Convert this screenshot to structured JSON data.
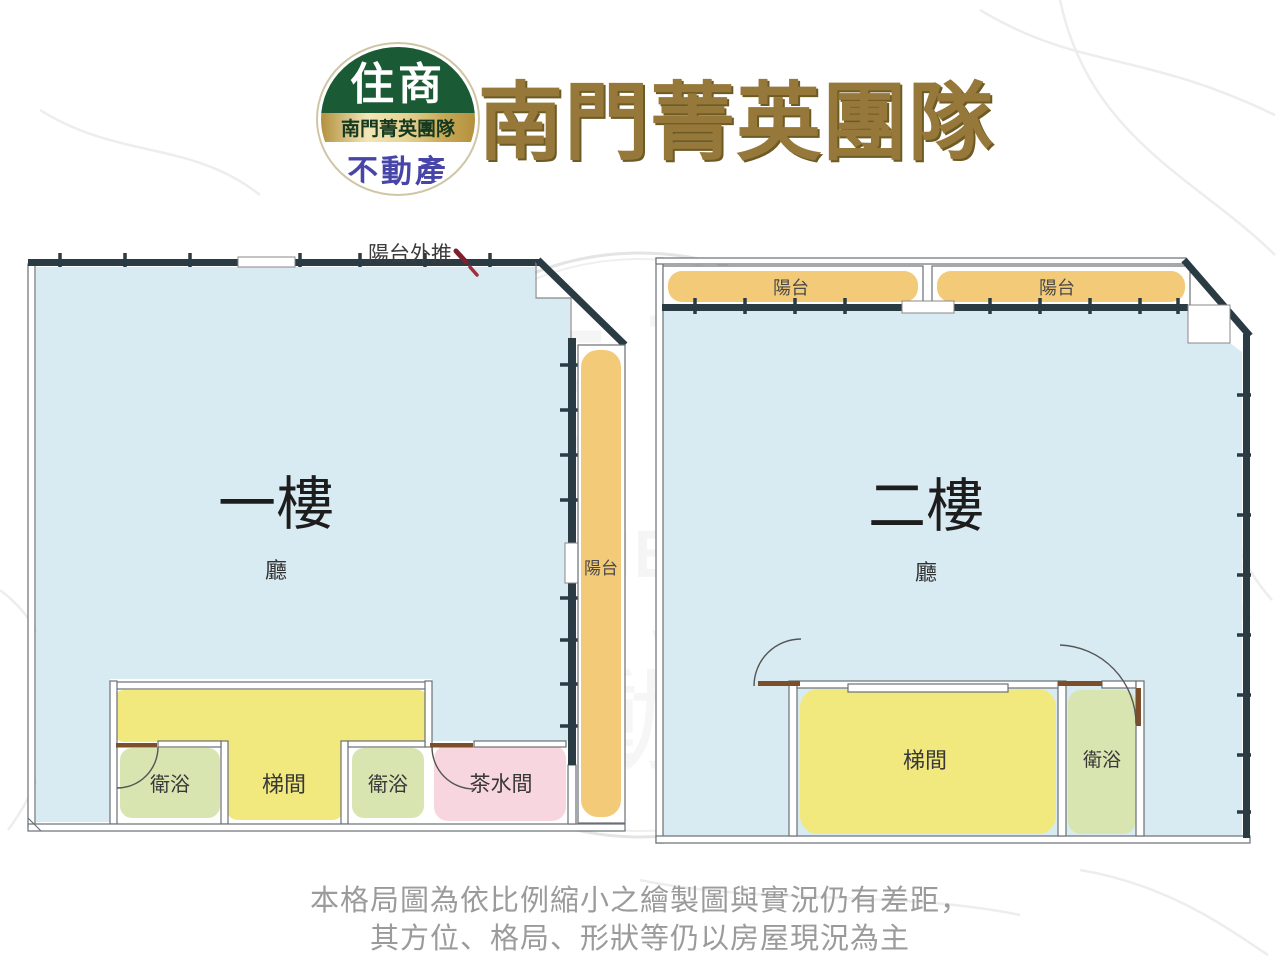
{
  "header": {
    "logo": {
      "top_text": "住商",
      "band_text": "南門菁英團隊",
      "bottom_text": "不動產"
    },
    "title": "南門菁英團隊"
  },
  "floor1": {
    "title": "一樓",
    "hall_label": "廳",
    "balcony_label": "陽台",
    "annotation": "陽台外推",
    "rooms": {
      "bath_left": "衛浴",
      "stairwell": "梯間",
      "bath_right": "衛浴",
      "tea_room": "茶水間"
    }
  },
  "floor2": {
    "title": "二樓",
    "hall_label": "廳",
    "balcony_left_label": "陽台",
    "balcony_right_label": "陽台",
    "rooms": {
      "stairwell": "梯間",
      "bath": "衛浴"
    }
  },
  "watermark": {
    "text_top": "住商",
    "text_middle": "南門菁英團隊",
    "text_bottom": "不動產"
  },
  "disclaimer": {
    "line1": "本格局圖為依比例縮小之繪製圖與實況仍有差距，",
    "line2": "其方位、格局、形狀等仍以房屋現況為主"
  },
  "colors": {
    "hall_fill": "#d9ebf2",
    "stair_fill": "#f1e87e",
    "bath_fill": "#d9e5b1",
    "tea_fill": "#f8d6df",
    "balcony_fill": "#f3ca77",
    "wall_dark": "#2b3b44",
    "logo_green": "#1a5a34",
    "logo_blue": "#4745a8",
    "title_gold": "#96783a",
    "annotation_red": "#8e2430",
    "disclaimer_gray": "#9b9b9b"
  }
}
